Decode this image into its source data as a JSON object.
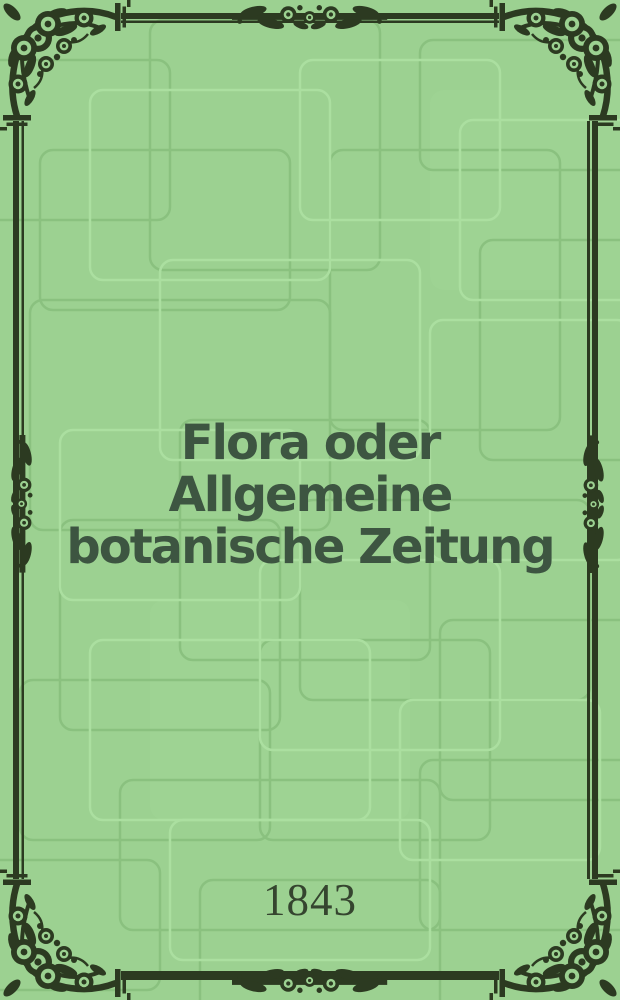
{
  "cover": {
    "kind": "journal-cover",
    "title_full": "Flora oder Allgemeine botanische Zeitung",
    "title_lines": [
      "Flora oder",
      "Allgemeine",
      "botanische Zeitung"
    ],
    "year": "1843"
  },
  "ornaments": {
    "corner_icon": "floral-rose-corner",
    "edge_center_icon": "floral-scroll-band",
    "side_center_icon": "floral-scroll-band-vertical",
    "border_style": "double-rule"
  },
  "colors": {
    "background": "#9cd191",
    "pattern_line_dark": "#8ac17f",
    "pattern_line_light": "#abdfa0",
    "frame": "#2c3a21",
    "title_text": "#3d5541",
    "year_text": "#35452f"
  }
}
